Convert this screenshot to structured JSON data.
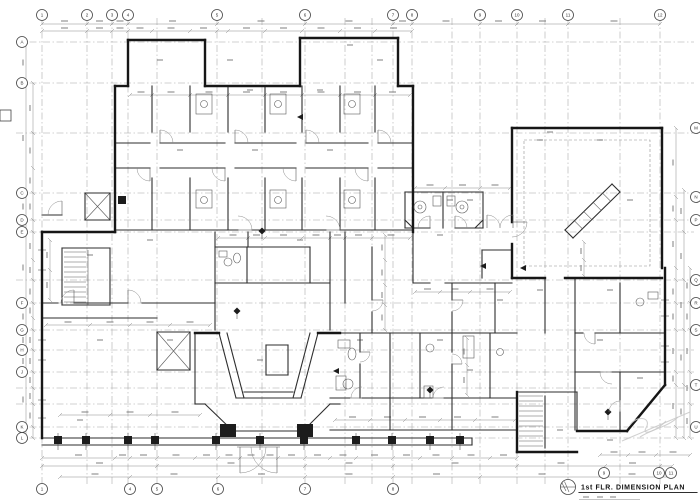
{
  "sheet": {
    "background": "#ffffff",
    "wall_ink": "#161616",
    "line_ink": "#2e2e2e",
    "detail_ink": "#5a5a5a",
    "grid_ink": "#a6a6a6",
    "faint_ink": "#c9c9c9"
  },
  "title_block": {
    "drawing_title": "1st FLR. DIMENSION PLAN"
  },
  "grid": {
    "top_labels": [
      "1",
      "2",
      "3",
      "4",
      "5",
      "6",
      "7",
      "8",
      "9",
      "10",
      "11",
      "12"
    ],
    "bottom_labels": [
      "1",
      "4",
      "5",
      "6",
      "7",
      "8"
    ],
    "bottom_right_labels": [
      "9",
      "10",
      "11"
    ],
    "left_labels": [
      "A",
      "B",
      "C",
      "D",
      "E",
      "F",
      "G",
      "H",
      "J",
      "K",
      "L"
    ],
    "right_labels": [
      "M",
      "N",
      "P",
      "Q",
      "R",
      "S",
      "T",
      "U"
    ]
  }
}
